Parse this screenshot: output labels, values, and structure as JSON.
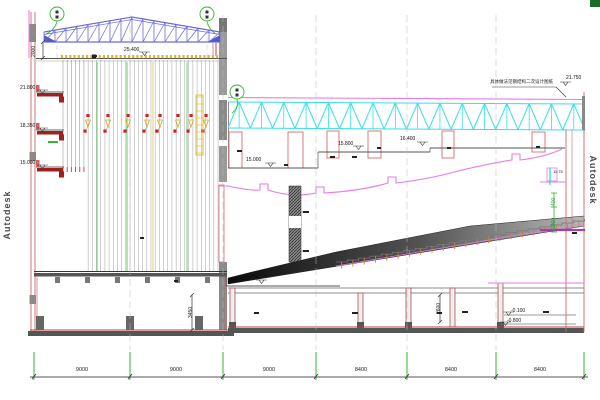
{
  "watermark": {
    "text": "Autodesk"
  },
  "notes": {
    "roof": "具体做法见钢结构二次设计图纸"
  },
  "levels": {
    "grid_top": "25.400",
    "gallery_1": "21.800",
    "gallery_2": "18.350",
    "gallery_3": "15.000",
    "aud_roof": "21.750",
    "ceil_1": "15.000",
    "ceil_2": "15.800",
    "ceil_3": "16.400",
    "stalls": "5.750",
    "base_1": "-0.100",
    "base_2": "-0.800",
    "right_side": "11.75"
  },
  "vdims": {
    "fly_grid": "2000",
    "trap": "3450",
    "base_room": "2600",
    "right_small": "400",
    "right_large": "2000"
  },
  "bottom_dims": [
    "9000",
    "9000",
    "9000",
    "8400",
    "8400",
    "8400"
  ],
  "colors": {
    "roof_truss_blue": "#6a6ada",
    "roof_truss_cyan": "#35dfe6",
    "ceiling_magenta": "#e87ae8",
    "wall_red": "#cc6666",
    "beam_dark_red": "#a02020",
    "grid_green": "#2db82d",
    "batten_yellow": "#d8b830"
  }
}
